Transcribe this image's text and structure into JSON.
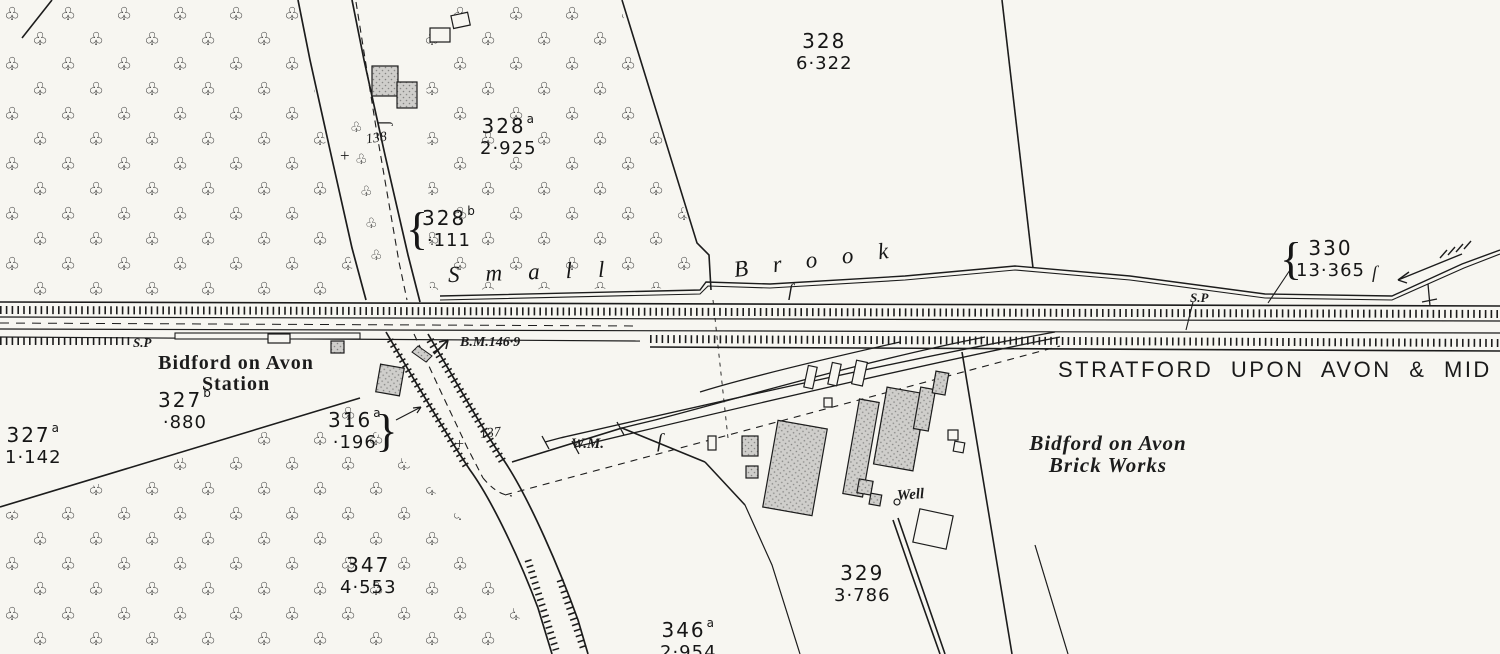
{
  "map": {
    "railway_name": "STRATFORD UPON AVON & MID",
    "station_name": {
      "line1": "Bidford on Avon",
      "line2": "Station"
    },
    "brick_works": {
      "line1": "Bidford on Avon",
      "line2": "Brick Works"
    },
    "brook_name": {
      "word1": "Small",
      "word2": "Brook"
    },
    "benchmark_label": "B.M.146·9",
    "well_label": "Well",
    "weighing_machine_label": "W.M.",
    "signal_post_left": "S.P",
    "signal_post_right": "S.P",
    "boundary_marks": {
      "mark_137": "137",
      "mark_138": "138"
    },
    "parcels": [
      {
        "number": "328",
        "suffix": "",
        "area": "6·322",
        "brace": ""
      },
      {
        "number": "328",
        "suffix": "a",
        "area": "2·925",
        "brace": ""
      },
      {
        "number": "328",
        "suffix": "b",
        "area": "·111",
        "brace": "{"
      },
      {
        "number": "330",
        "suffix": "",
        "area": "13·365",
        "brace": "{"
      },
      {
        "number": "327",
        "suffix": "b",
        "area": "·880",
        "brace": ""
      },
      {
        "number": "327",
        "suffix": "a",
        "area": "1·142",
        "brace": ""
      },
      {
        "number": "316",
        "suffix": "a",
        "area": "·196",
        "brace": "}"
      },
      {
        "number": "347",
        "suffix": "",
        "area": "4·553",
        "brace": ""
      },
      {
        "number": "329",
        "suffix": "",
        "area": "3·786",
        "brace": ""
      },
      {
        "number": "346",
        "suffix": "a",
        "area": "2·954",
        "brace": ""
      }
    ],
    "icons": {
      "tree": "♧",
      "mereing_mark": "ſ",
      "boundary_cross": "+"
    },
    "colors": {
      "ink": "#1c1c1c",
      "paper": "#f7f6f1",
      "building_fill": "#cfcecb"
    }
  }
}
